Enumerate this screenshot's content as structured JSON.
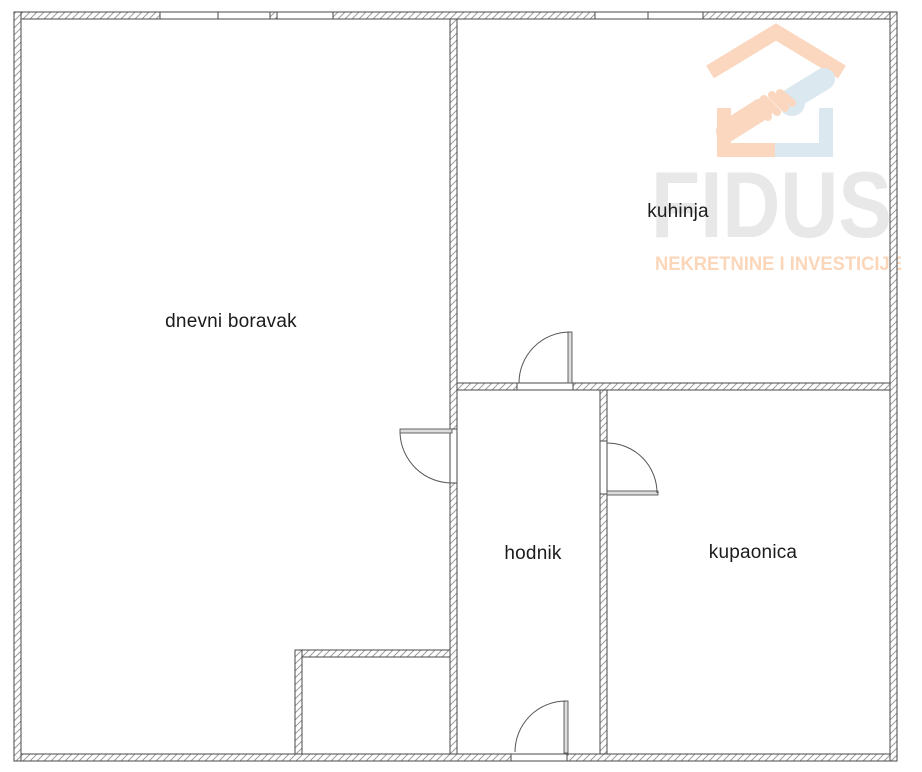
{
  "canvas": {
    "width": 922,
    "height": 772
  },
  "plan": {
    "type": "apartment-floor-plan",
    "rooms": [
      {
        "id": "dnevni-boravak",
        "label": "dnevni boravak",
        "center_x": 231,
        "center_y": 322
      },
      {
        "id": "kuhinja",
        "label": "kuhinja",
        "center_x": 678,
        "center_y": 212
      },
      {
        "id": "hodnik",
        "label": "hodnik",
        "center_x": 533,
        "center_y": 554
      },
      {
        "id": "kupaonica",
        "label": "kupaonica",
        "center_x": 753,
        "center_y": 553
      }
    ],
    "features": {
      "windows": 2,
      "doors": 4,
      "door_style": "quarter-circle swing arcs",
      "wall_style": "diagonal hatch"
    }
  },
  "watermark": {
    "brand": "FIDUS",
    "tagline": "NEKRETNINE I INVESTICIJE",
    "icon": "house-with-handshake"
  },
  "colors": {
    "background": "#ffffff",
    "wall_outline": "#4a4a4a",
    "wall_hatch": "#9e9e9e",
    "door_line": "#555555",
    "door_leaf_fill": "#dcdcdc",
    "label_text": "#1b1b1b",
    "brand_gray": "#e8e8e8",
    "brand_peach": "#fbd7bf",
    "brand_blue": "#dbe8f0"
  }
}
